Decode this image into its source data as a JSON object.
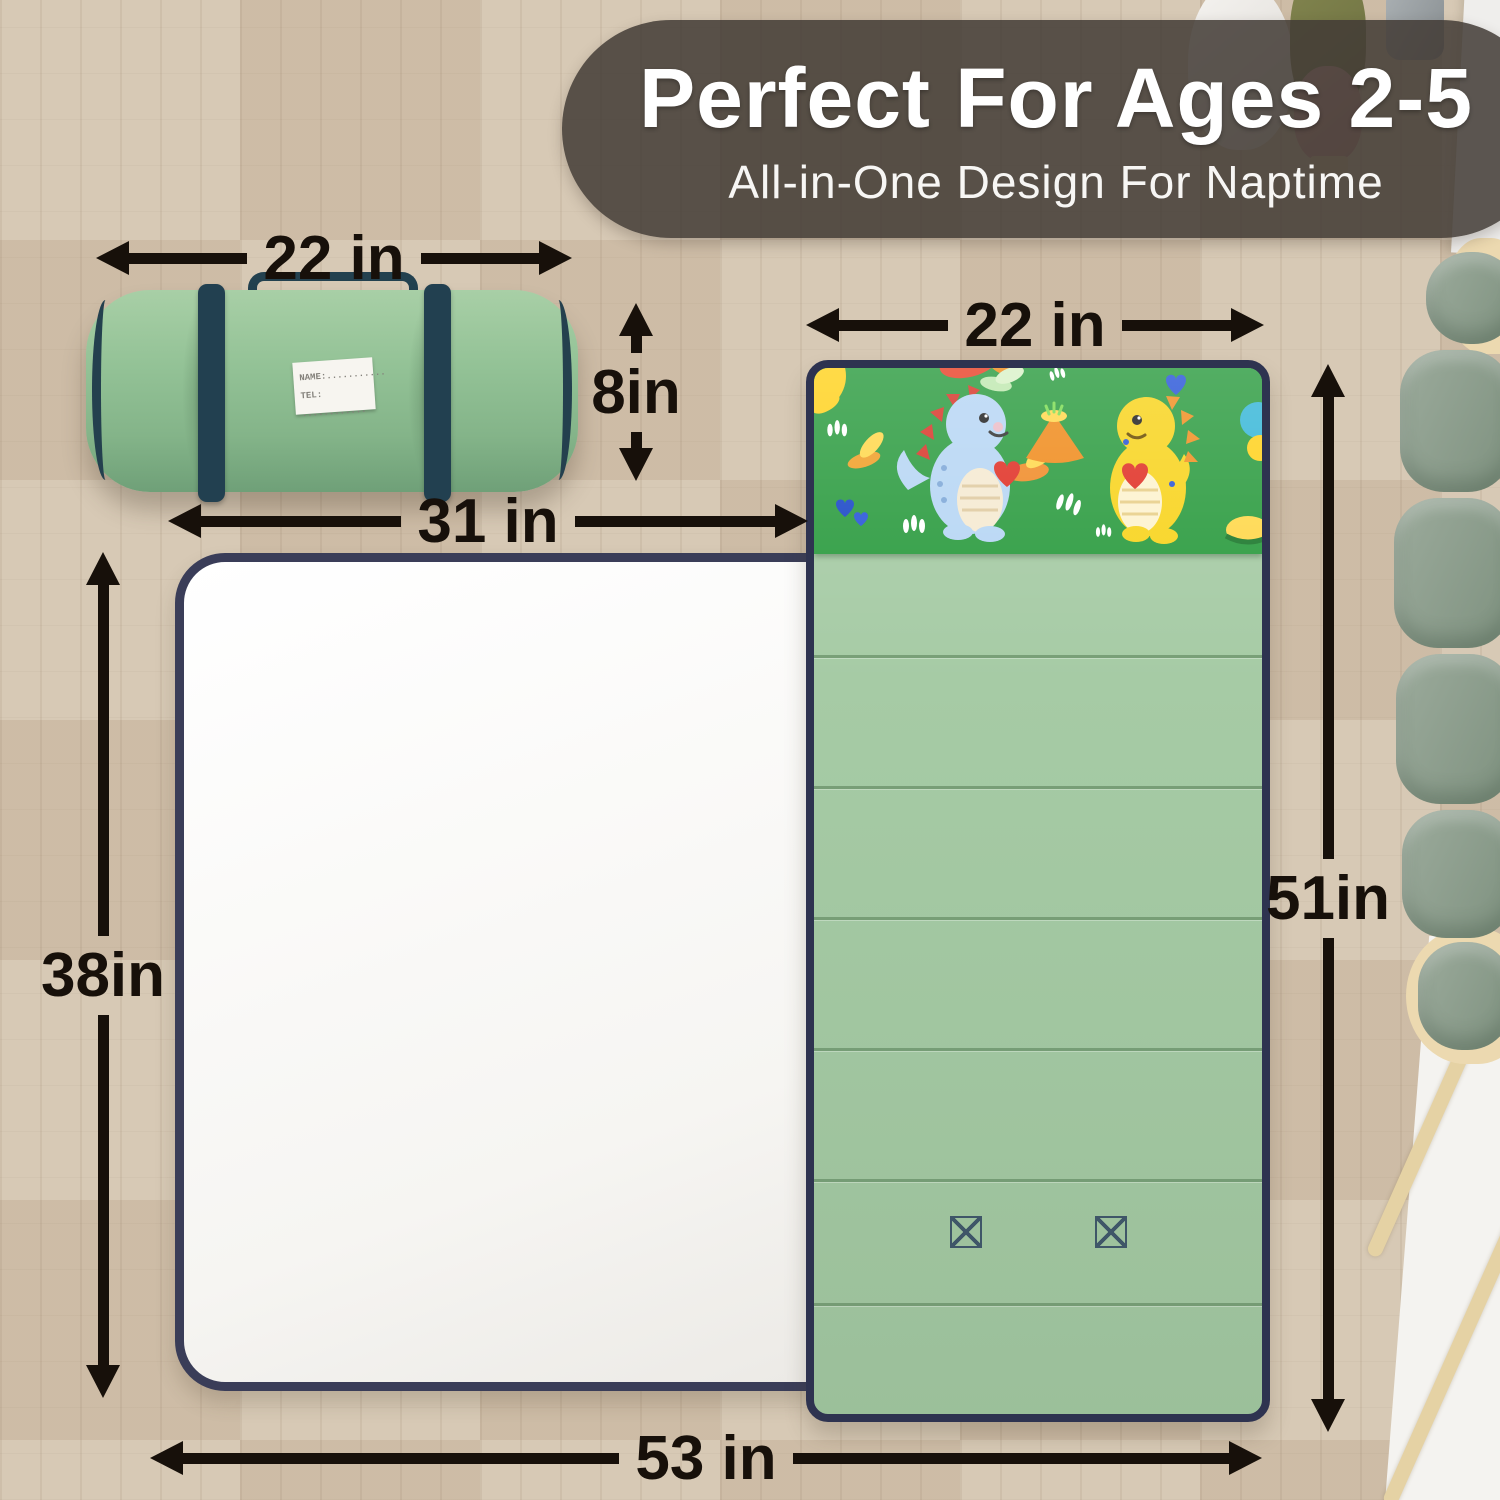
{
  "banner": {
    "title": "Perfect For Ages 2-5",
    "subtitle": "All-in-One Design For Naptime"
  },
  "dimensions": {
    "roll_width": "22 in",
    "pillow_width": "22 in",
    "pillow_height": "8in",
    "blanket_width": "31 in",
    "blanket_height": "38in",
    "mat_length": "51in",
    "total_length": "53 in"
  },
  "rolled_mat_tag": {
    "name_line": "NAME:...........",
    "tel_line": "TEL: ............"
  },
  "colors": {
    "annotation_black": "#17100a",
    "banner_overlay": "#423b35",
    "mat_green": "#a6cba5",
    "roll_green": "#8fbc92",
    "pillow_print_green": "#2d9c41",
    "binding_navy": "#2e3350",
    "strap_navy": "#23414f",
    "blanket_white": "#fbfbfa",
    "floor_wood": "#d5c6b0"
  }
}
